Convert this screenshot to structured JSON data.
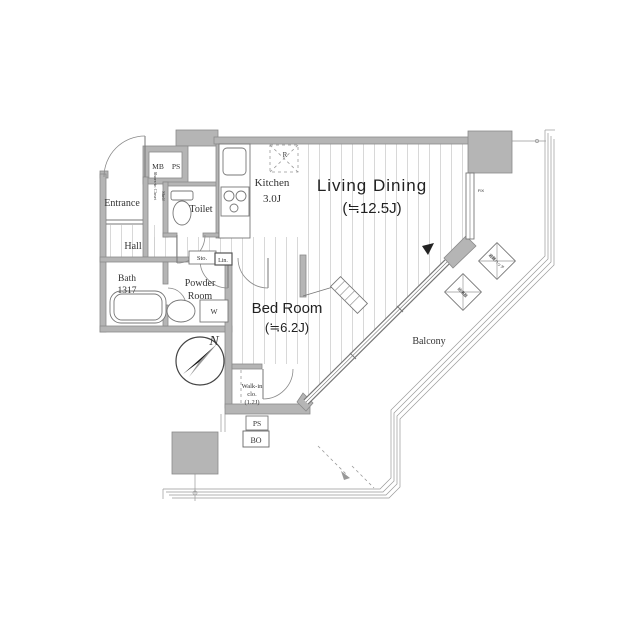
{
  "plan_title": "apartment-floor-plan",
  "rooms": {
    "living_dining": {
      "name": "Living Dining",
      "size": "(≒12.5J)"
    },
    "bed_room": {
      "name": "Bed Room",
      "size": "(≒6.2J)"
    },
    "kitchen": {
      "name": "Kitchen",
      "size": "3.0J"
    },
    "entrance": {
      "name": "Entrance"
    },
    "hall": {
      "name": "Hall"
    },
    "toilet": {
      "name": "Toilet"
    },
    "bath": {
      "name": "Bath",
      "size": "1317"
    },
    "powder_room": {
      "line1": "Powder",
      "line2": "Room"
    },
    "walk_in_closet": {
      "line1": "Walk-in",
      "line2": "clo.",
      "line3": "(1.2J)"
    },
    "balcony": {
      "name": "Balcony"
    }
  },
  "labels": {
    "mb": "MB",
    "ps": "PS",
    "refrigerator": "R",
    "storage": "Sto.",
    "linen": "Lin.",
    "washer": "W",
    "shoes_closet": "Shoes-in Closet",
    "shelf": "Shelf",
    "pipe_shaft": "PS",
    "bo": "BO",
    "north": "N",
    "fix_window": "FIX",
    "hatch_equipment": "避難ハッチ",
    "heater_equipment": "給湯器"
  },
  "colors": {
    "wall_fill": "#b5b5b5",
    "wall_stroke": "#8a8a8a",
    "line": "#777777",
    "floor_hatch": "#cfcfcf",
    "text": "#333333",
    "compass_dark": "#1a1a1a",
    "compass_gray": "#9a9a9a"
  }
}
